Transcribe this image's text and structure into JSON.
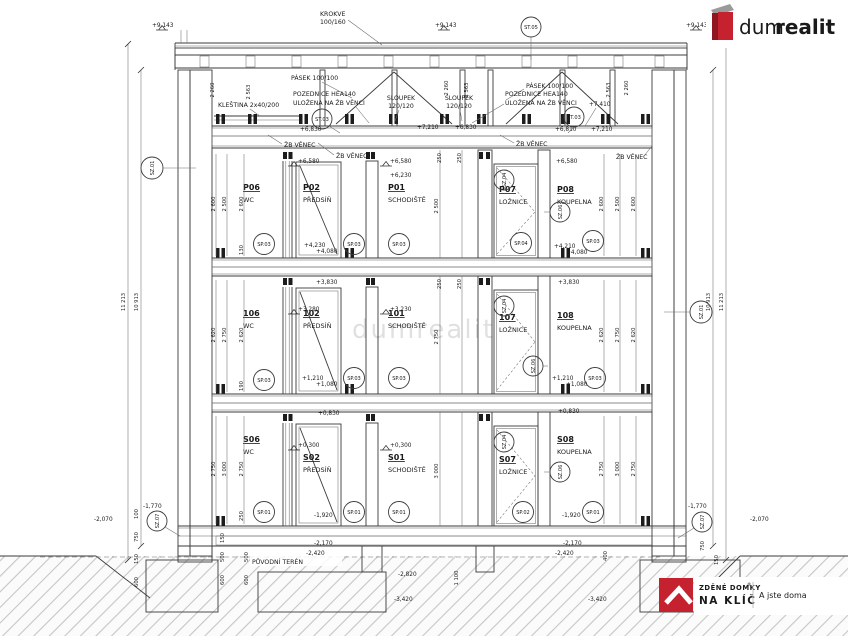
{
  "branding": {
    "logo_top": {
      "name_gray": "dum",
      "name_red": "realit"
    },
    "logo_bottom": {
      "line1": "ZDĚNÉ DOMKY",
      "reg": "®",
      "line2": "NA KLÍČ",
      "tagline": "A jste doma"
    },
    "watermark": "dumrealit",
    "colors": {
      "brand_red": "#c5212e",
      "brand_gray": "#8d8d8d"
    }
  },
  "annotations": {
    "krokve_l1": "KROKVE",
    "krokve_l2": "100/160",
    "pasek": "PÁSEK 100/100",
    "pozednice_l1": "POZEDNICE HEA140",
    "pozednice_l2": "ULOŽENA NA ŽB VĚNCI",
    "sloupek_l1": "SLOUPEK",
    "sloupek_l2": "120/120",
    "klestina": "KLEŠTINA 2x40/200",
    "zb_venec": "ŽB VĚNEC",
    "puvodni_teren": "PŮVODNÍ TERÉN"
  },
  "floors": [
    {
      "rooms": [
        {
          "num": "P06",
          "name": "WC"
        },
        {
          "num": "P02",
          "name": "PŘEDSÍŇ"
        },
        {
          "num": "P01",
          "name": "SCHODIŠTĚ"
        },
        {
          "num": "P07",
          "name": "LOŽNICE"
        },
        {
          "num": "P08",
          "name": "KOUPELNA"
        }
      ]
    },
    {
      "rooms": [
        {
          "num": "106",
          "name": "WC"
        },
        {
          "num": "102",
          "name": "PŘEDSÍŇ"
        },
        {
          "num": "101",
          "name": "SCHODIŠTĚ"
        },
        {
          "num": "107",
          "name": "LOŽNICE"
        },
        {
          "num": "108",
          "name": "KOUPELNA"
        }
      ]
    },
    {
      "rooms": [
        {
          "num": "S06",
          "name": "WC"
        },
        {
          "num": "S02",
          "name": "PŘEDSÍŇ"
        },
        {
          "num": "S01",
          "name": "SCHODIŠTĚ"
        },
        {
          "num": "S07",
          "name": "LOŽNICE"
        },
        {
          "num": "S08",
          "name": "KOUPELNA"
        }
      ]
    }
  ],
  "elevations": {
    "p9143": "+9,143",
    "p7410": "+7,410",
    "p7210": "+7,210",
    "p6830": "+6,830",
    "p6810": "+6,810",
    "p6580": "+6,580",
    "p6230": "+6,230",
    "p4230": "+4,230",
    "p4210": "+4,210",
    "p4080": "+4,080",
    "p3830": "+3,830",
    "p3280": "+3,280",
    "p3230": "+3,230",
    "p1210": "+1,210",
    "p1080": "+1,080",
    "p0830": "+0,830",
    "p0300": "+0,300",
    "m1920": "-1,920",
    "m1770": "-1,770",
    "m2070": "-2,070",
    "m2170": "-2,170",
    "m2420": "-2,420",
    "m2820": "-2,820",
    "m3420": "-3,420"
  },
  "marks": {
    "st05": "ST.05",
    "st03": "ST.03",
    "sz01": "SZ.01",
    "sz04": "SZ.04",
    "sz06": "SZ.06",
    "sz07": "SZ.07",
    "sp01": "SP.01",
    "sp02": "SP.02",
    "sp03": "SP.03",
    "sp04": "SP.04"
  },
  "dims": {
    "total_outer": "11 213",
    "total_inner": "10 913",
    "attic_a": "2 260",
    "attic_b": "2 563",
    "f2": [
      "2 600",
      "2 500",
      "2 600"
    ],
    "f1": [
      "2 620",
      "2 750",
      "2 620"
    ],
    "f0": [
      "2 750",
      "3 000",
      "2 750"
    ],
    "d130": "130",
    "d250": "250",
    "d190": "190",
    "d100": "100",
    "d750": "750",
    "d150": "150",
    "d600": "600",
    "d500": "500",
    "d400": "400",
    "d1100": "1 100"
  }
}
